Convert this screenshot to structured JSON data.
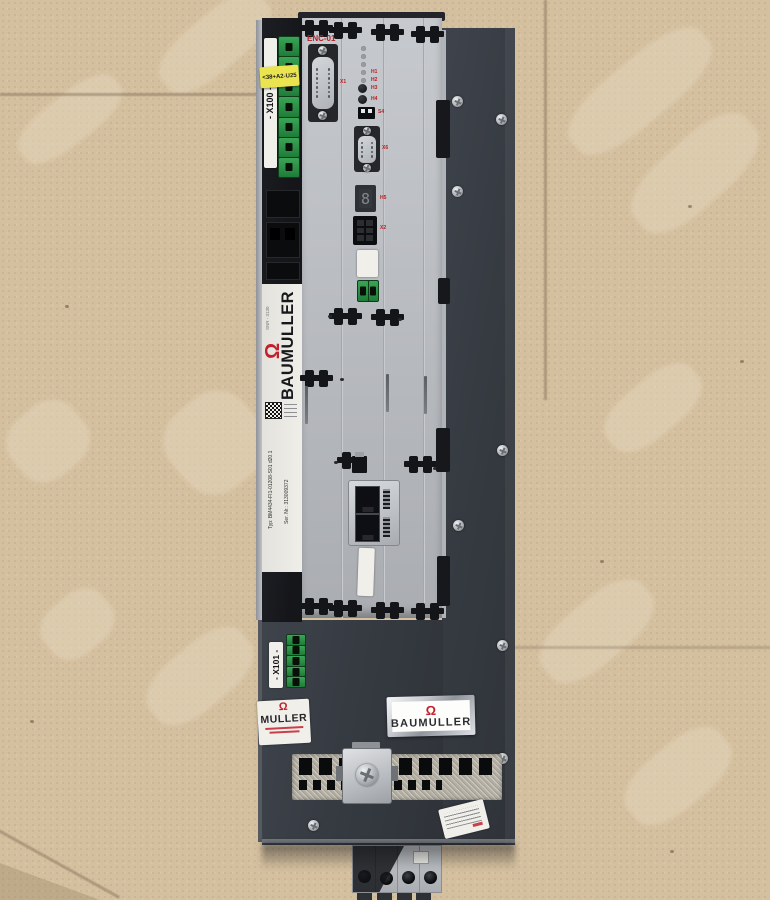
{
  "scene": {
    "floor_color": "#d4bf9e",
    "chassis_color": "#363b42",
    "panel_color": "#bdc0c5",
    "accent_red": "#c3202c",
    "terminal_green": "#2c9247",
    "sticker_yellow": "#e9e44f",
    "logo_glyph": "Ω"
  },
  "device": {
    "left_module": {
      "x100_display": "- X100 -",
      "sticker_text": "<38+A2-U25"
    },
    "controller": {
      "enc_label": "ENC-01",
      "seven_segment_value": "8",
      "labels": {
        "led_a": "H1",
        "led_b": "H2",
        "button_a": "H3",
        "button_b": "H4",
        "dip": "S4",
        "display": "H5",
        "db15": "X1",
        "db9": "X6",
        "io_connector": "X2"
      }
    },
    "nameplate": {
      "top_small_text": "SNR - 3130",
      "brand_vertical": "BAUMULLER",
      "typ_label": "Typ:",
      "typ_value": "BM4434-FI1-01208-S01 d20.1",
      "ser_label": "Ser. Nr.:",
      "ser_value": "313009372"
    },
    "bottom_section": {
      "x101_display": "- X101 -",
      "small_label_text": "MULLER",
      "brand_label_text": "BAUMULLER"
    }
  }
}
